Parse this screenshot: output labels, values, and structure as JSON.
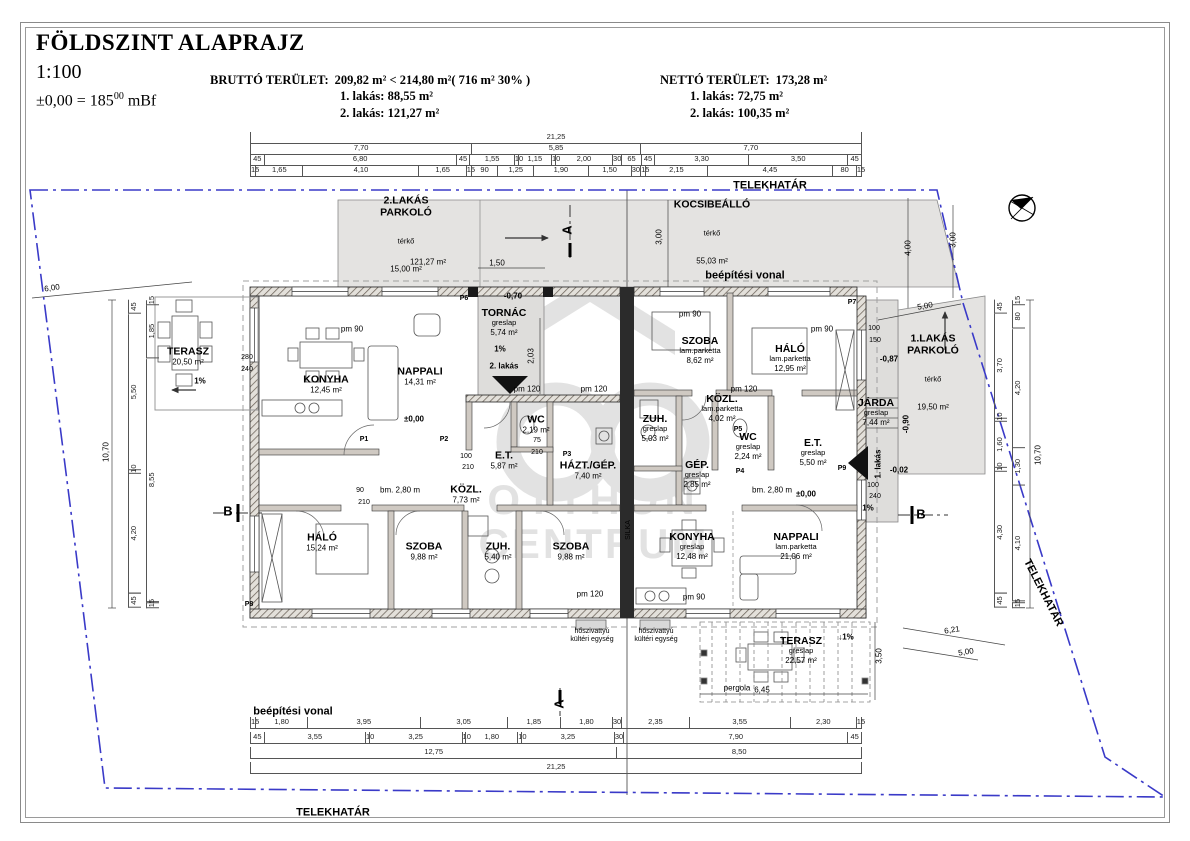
{
  "title": {
    "main": "FÖLDSZINT ALAPRAJZ",
    "scale": "1:100",
    "level_prefix": "±0,00 = 185",
    "level_sup": "00",
    "level_suffix": " mBf"
  },
  "areas": {
    "brutto_label": "BRUTTÓ TERÜLET:",
    "brutto_value": "209,82  m² < 214,80 m²( 716 m² 30% )",
    "brutto_lines": [
      "1. lakás: 88,55 m²",
      "2. lakás: 121,27 m²"
    ],
    "netto_label": "NETTÓ TERÜLET:",
    "netto_value": "173,28 m²",
    "netto_lines": [
      "1. lakás: 72,75 m²",
      "2. lakás: 100,35 m²"
    ]
  },
  "watermark": {
    "line1": "OTTHON",
    "line2": "CENTRUM"
  },
  "rooms": [
    {
      "name": "TERASZ",
      "area": "20,50 m²",
      "x": 188,
      "y": 356
    },
    {
      "name": "KONYHA",
      "area": "12,45 m²",
      "x": 326,
      "y": 384
    },
    {
      "name": "NAPPALI",
      "area": "14,31 m²",
      "x": 420,
      "y": 376
    },
    {
      "name": "TORNÁC",
      "finish": "greslap",
      "area": "5,74 m²",
      "x": 504,
      "y": 322
    },
    {
      "name": "E.T.",
      "area": "5,87 m²",
      "x": 504,
      "y": 460
    },
    {
      "name": "WC",
      "area": "2,19 m²",
      "x": 536,
      "y": 424
    },
    {
      "name": "HÁZT./GÉP.",
      "area": "7,40 m²",
      "x": 588,
      "y": 470
    },
    {
      "name": "KÖZL.",
      "area": "7,73 m²",
      "x": 466,
      "y": 494
    },
    {
      "name": "HÁLÓ",
      "area": "15,24 m²",
      "x": 322,
      "y": 542
    },
    {
      "name": "SZOBA",
      "area": "9,88 m²",
      "x": 424,
      "y": 551
    },
    {
      "name": "ZUH.",
      "area": "5,40 m²",
      "x": 498,
      "y": 551
    },
    {
      "name": "SZOBA",
      "area": "9,88 m²",
      "x": 571,
      "y": 551
    },
    {
      "name": "SZOBA",
      "finish": "lam.parketta",
      "area": "8,62 m²",
      "x": 700,
      "y": 350
    },
    {
      "name": "HÁLÓ",
      "finish": "lam.parketta",
      "area": "12,95 m²",
      "x": 790,
      "y": 358
    },
    {
      "name": "KÖZL.",
      "finish": "lam.parketta",
      "area": "4,02 m²",
      "x": 722,
      "y": 408
    },
    {
      "name": "ZUH.",
      "finish": "greslap",
      "area": "5,03 m²",
      "x": 655,
      "y": 428
    },
    {
      "name": "GÉP.",
      "finish": "greslap",
      "area": "2,85 m²",
      "x": 697,
      "y": 474
    },
    {
      "name": "WC",
      "finish": "greslap",
      "area": "2,24 m²",
      "x": 748,
      "y": 446
    },
    {
      "name": "E.T.",
      "finish": "greslap",
      "area": "5,50 m²",
      "x": 813,
      "y": 452
    },
    {
      "name": "KONYHA",
      "finish": "greslap",
      "area": "12,48 m²",
      "x": 692,
      "y": 546
    },
    {
      "name": "NAPPALI",
      "finish": "lam.parketta",
      "area": "21,06 m²",
      "x": 796,
      "y": 546
    },
    {
      "name": "JÁRDA",
      "finish": "greslap",
      "area": "7,44 m²",
      "x": 876,
      "y": 412
    },
    {
      "name": "TERASZ",
      "finish": "greslap",
      "area": "22,57 m²",
      "x": 801,
      "y": 650
    }
  ],
  "outdoor": [
    {
      "name": "2.LAKÁS\nPARKOLÓ",
      "finish": "térkő",
      "area": "15,00 m²",
      "x": 406,
      "y": 234
    },
    {
      "name": "KOCSIBEÁLLÓ",
      "finish": "térkő",
      "area": "55,03 m²",
      "x": 712,
      "y": 232
    },
    {
      "name": "1.LAKÁS\nPARKOLÓ",
      "finish": "térkő",
      "area": "19,50 m²",
      "x": 933,
      "y": 372
    }
  ],
  "site_labels": [
    {
      "t": "TELEKHATÁR",
      "x": 770,
      "y": 186
    },
    {
      "t": "TELEKHATÁR",
      "x": 333,
      "y": 813
    },
    {
      "t": "TELEKHATÁR",
      "x": 1043,
      "y": 593,
      "r": 63
    },
    {
      "t": "beépítési vonal",
      "x": 745,
      "y": 276
    },
    {
      "t": "beépítési vonal",
      "x": 293,
      "y": 712
    }
  ],
  "small_labels": [
    {
      "t": "-0,70",
      "x": 513,
      "y": 296,
      "w": 700
    },
    {
      "t": "±0,00",
      "x": 414,
      "y": 419,
      "w": 700
    },
    {
      "t": "±0,00",
      "x": 806,
      "y": 494,
      "w": 700
    },
    {
      "t": "-0,87",
      "x": 889,
      "y": 359,
      "w": 700
    },
    {
      "t": "-0,90",
      "x": 906,
      "y": 424,
      "r": -90,
      "w": 700
    },
    {
      "t": "-0,02",
      "x": 899,
      "y": 470,
      "w": 700
    },
    {
      "t": "2. lakás",
      "x": 504,
      "y": 366,
      "w": 700
    },
    {
      "t": "1. lakás",
      "x": 878,
      "y": 464,
      "r": -90,
      "w": 700
    },
    {
      "t": "bm. 2,80 m",
      "x": 400,
      "y": 490
    },
    {
      "t": "bm. 2,80 m",
      "x": 772,
      "y": 490
    },
    {
      "t": "pm 90",
      "x": 352,
      "y": 329
    },
    {
      "t": "pm 90",
      "x": 822,
      "y": 329
    },
    {
      "t": "pm 90",
      "x": 690,
      "y": 314
    },
    {
      "t": "pm 120",
      "x": 527,
      "y": 389
    },
    {
      "t": "pm 120",
      "x": 594,
      "y": 389
    },
    {
      "t": "pm 120",
      "x": 744,
      "y": 389
    },
    {
      "t": "pm 120",
      "x": 590,
      "y": 594
    },
    {
      "t": "pm 90",
      "x": 694,
      "y": 597
    },
    {
      "t": "hőszivattyú\nkültéri egység",
      "x": 592,
      "y": 636,
      "s": 7
    },
    {
      "t": "hőszivattyú\nkültéri egység",
      "x": 656,
      "y": 636,
      "s": 7
    },
    {
      "t": "pergola",
      "x": 737,
      "y": 688
    },
    {
      "t": "SILKA",
      "x": 629,
      "y": 530,
      "r": -90,
      "s": 7
    },
    {
      "t": "280",
      "x": 247,
      "y": 358,
      "s": 7
    },
    {
      "t": "240",
      "x": 247,
      "y": 370,
      "s": 7
    },
    {
      "t": "2,03",
      "x": 531,
      "y": 356,
      "r": -90
    },
    {
      "t": "1,50",
      "x": 497,
      "y": 263
    },
    {
      "t": "121,27 m²",
      "x": 428,
      "y": 262
    },
    {
      "t": "3,00",
      "x": 659,
      "y": 237,
      "r": -90
    },
    {
      "t": "3,00",
      "x": 953,
      "y": 240,
      "r": -90
    },
    {
      "t": "4,00",
      "x": 908,
      "y": 248,
      "r": -90
    },
    {
      "t": "5,00",
      "x": 925,
      "y": 306,
      "r": -10
    },
    {
      "t": "6,00",
      "x": 52,
      "y": 288,
      "r": -8
    },
    {
      "t": "6,45",
      "x": 762,
      "y": 690
    },
    {
      "t": "3,50",
      "x": 879,
      "y": 656,
      "r": -90
    },
    {
      "t": "6,21",
      "x": 952,
      "y": 630,
      "r": -9
    },
    {
      "t": "5,00",
      "x": 966,
      "y": 652,
      "r": -9
    },
    {
      "t": "1%",
      "x": 200,
      "y": 381,
      "w": 700
    },
    {
      "t": "1%",
      "x": 500,
      "y": 349,
      "w": 700
    },
    {
      "t": "↓1%",
      "x": 846,
      "y": 637,
      "w": 700
    },
    {
      "t": "1%",
      "x": 868,
      "y": 508,
      "w": 700
    },
    {
      "t": "10,70",
      "x": 106,
      "y": 452,
      "r": -90
    },
    {
      "t": "10,70",
      "x": 1038,
      "y": 455,
      "r": -90
    },
    {
      "t": "P1",
      "x": 364,
      "y": 440,
      "w": 700,
      "s": 7
    },
    {
      "t": "P2",
      "x": 444,
      "y": 440,
      "w": 700,
      "s": 7
    },
    {
      "t": "P3",
      "x": 567,
      "y": 455,
      "w": 700,
      "s": 7
    },
    {
      "t": "P4",
      "x": 740,
      "y": 472,
      "w": 700,
      "s": 7
    },
    {
      "t": "P5",
      "x": 738,
      "y": 430,
      "w": 700,
      "s": 7
    },
    {
      "t": "P6",
      "x": 464,
      "y": 299,
      "w": 700,
      "s": 7
    },
    {
      "t": "P7",
      "x": 852,
      "y": 303,
      "w": 700,
      "s": 7
    },
    {
      "t": "P8",
      "x": 249,
      "y": 605,
      "w": 700,
      "s": 7
    },
    {
      "t": "P9",
      "x": 842,
      "y": 469,
      "w": 700,
      "s": 7
    },
    {
      "t": "A",
      "x": 568,
      "y": 230,
      "w": 700,
      "s": 13,
      "r": -90
    },
    {
      "t": "A",
      "x": 560,
      "y": 704,
      "w": 700,
      "s": 13,
      "r": -90
    },
    {
      "t": "B",
      "x": 228,
      "y": 512,
      "w": 700,
      "s": 13
    },
    {
      "t": "B",
      "x": 921,
      "y": 515,
      "w": 700,
      "s": 13
    },
    {
      "t": "100",
      "x": 466,
      "y": 457,
      "s": 7
    },
    {
      "t": "210",
      "x": 468,
      "y": 468,
      "s": 7
    },
    {
      "t": "75",
      "x": 537,
      "y": 441,
      "s": 7
    },
    {
      "t": "210",
      "x": 537,
      "y": 453,
      "s": 7
    },
    {
      "t": "90",
      "x": 360,
      "y": 491,
      "s": 7
    },
    {
      "t": "210",
      "x": 364,
      "y": 503,
      "s": 7
    },
    {
      "t": "100",
      "x": 873,
      "y": 486,
      "s": 7
    },
    {
      "t": "240",
      "x": 875,
      "y": 497,
      "s": 7
    },
    {
      "t": "100",
      "x": 874,
      "y": 329,
      "s": 7
    },
    {
      "t": "150",
      "x": 875,
      "y": 341,
      "s": 7
    }
  ],
  "dims": {
    "top_row1": [
      "21,25"
    ],
    "top_row2": [
      "7,70",
      "5,85",
      "7,70"
    ],
    "top_row3": [
      "45",
      "6,80",
      "45",
      "1,55",
      "10",
      "1,15",
      "10",
      "2,00",
      "30",
      "65",
      "45",
      "3,30",
      "3,50",
      "45"
    ],
    "top_row4": [
      "15",
      "1,65",
      "4,10",
      "1,65",
      "15",
      "90",
      "1,25",
      "1,90",
      "1,50",
      "30",
      "15",
      "2,15",
      "4,45",
      "80",
      "15"
    ],
    "bottom_row1": [
      "15",
      "1,80",
      "3,95",
      "3,05",
      "1,85",
      "1,80",
      "30",
      "2,35",
      "3,55",
      "2,30",
      "15"
    ],
    "bottom_row2": [
      "45",
      "3,55",
      "10",
      "3,25",
      "10",
      "1,80",
      "10",
      "3,25",
      "30",
      "7,90",
      "45"
    ],
    "bottom_row3": [
      "12,75",
      "8,50"
    ],
    "bottom_row4": [
      "21,25"
    ],
    "left_col_a": [
      "45",
      "5,50",
      "10",
      "4,20",
      "45"
    ],
    "left_col_b": [
      "15",
      "1,85",
      "8,55",
      "15"
    ],
    "right_col_inner": [
      "45",
      "3,70",
      "10",
      "1,60",
      "10",
      "4,30",
      "45"
    ],
    "right_col_outer": [
      "15",
      "80",
      "4,20",
      "1,30",
      "4,10",
      "15"
    ]
  }
}
